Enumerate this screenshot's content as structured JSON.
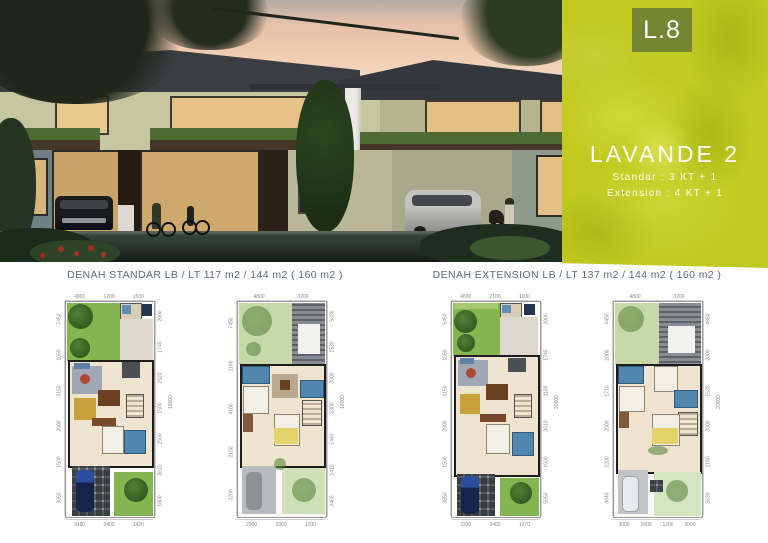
{
  "panel": {
    "code": "L.8",
    "title": "LAVANDE 2",
    "spec_standard": "Standar :   3 KT + 1",
    "spec_extension": "Extension : 4 KT + 1"
  },
  "plans": {
    "standard": {
      "caption": "DENAH STANDAR  LB / LT  117 m2 / 144 m2 ( 160 m2 )"
    },
    "extension": {
      "caption": "DENAH EXTENSION  LB / LT  137 m2 / 144 m2 (  160 m2 )"
    },
    "sheets": [
      {
        "name": "standard-ground-floor",
        "dims": {
          "top": [
            "4800",
            "1700",
            "1500"
          ],
          "bottom": [
            "3180",
            "3400",
            "1420"
          ],
          "left": [
            "7450",
            "1050",
            "3150",
            "2000",
            "1500",
            "3050"
          ],
          "right": [
            "2000",
            "1745",
            "2520",
            "1500",
            "2500",
            "3610",
            "1800"
          ],
          "total": "18000"
        }
      },
      {
        "name": "standard-upper-floor",
        "dims": {
          "top": [
            "4800",
            "3200"
          ],
          "bottom": [
            "2900",
            "3900",
            "1200"
          ],
          "left": [
            "7450",
            "1100",
            "4100",
            "2150",
            "3200"
          ],
          "right": [
            "5030",
            "1530",
            "2000",
            "1300",
            "1440",
            "1410",
            "3460"
          ],
          "total": "18000"
        }
      },
      {
        "name": "extension-ground-floor",
        "dims": {
          "top": [
            "4800",
            "2100",
            "1100"
          ],
          "bottom": [
            "3330",
            "3400",
            "1270"
          ],
          "left": [
            "5450",
            "1050",
            "4150",
            "2000",
            "1500",
            "3850"
          ],
          "right": [
            "2000",
            "1745",
            "1100",
            "3610",
            "1500",
            "5050"
          ],
          "total": "20000"
        }
      },
      {
        "name": "extension-upper-floor",
        "dims": {
          "top": [
            "4800",
            "3200"
          ],
          "bottom": [
            "3000",
            "1800",
            "1200",
            "2000"
          ],
          "left": [
            "4450",
            "2000",
            "1710",
            "2000",
            "2200",
            "3640"
          ],
          "right": [
            "4650",
            "2000",
            "1530",
            "2000",
            "2190",
            "2630"
          ],
          "total": "20000"
        }
      }
    ]
  },
  "colors": {
    "panel_lime": "#c0ca20",
    "code_badge_olive": "#6e8034",
    "caption_gray_blue": "#5d6b7a",
    "dusk_sky_peach": "#efc9ae",
    "roof_dark": "#3a3e42"
  }
}
